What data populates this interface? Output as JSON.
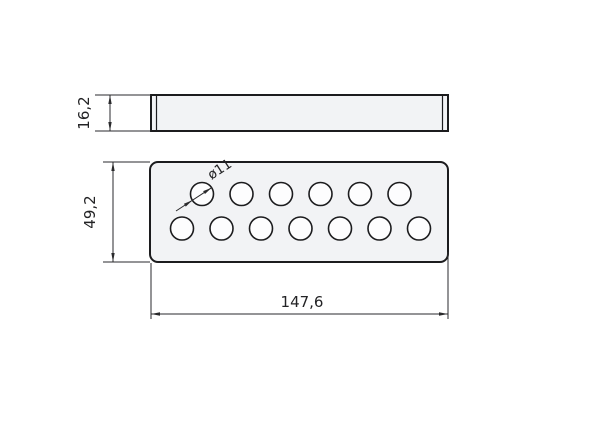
{
  "drawing": {
    "description": "Two-view technical drawing of a perforated rectangular plate",
    "colors": {
      "background": "#ffffff",
      "outline": "#1c1c1e",
      "plate_fill": "#f2f3f5",
      "hole_fill": "#fdfdfe",
      "dim_line": "#2a2a2c",
      "text": "#232325"
    },
    "side_view": {
      "x": 151,
      "y": 95,
      "width": 297,
      "height": 36,
      "inner_edge_offset": 5.5
    },
    "top_view": {
      "x": 150,
      "y": 162,
      "width": 298,
      "height": 100,
      "corner_radius": 8
    },
    "holes": {
      "count": 13,
      "radius": 11.5,
      "rows": [
        {
          "cy": 194,
          "cx": [
            202,
            241.5,
            281,
            320.5,
            360,
            399.5
          ]
        },
        {
          "cy": 228.5,
          "cx": [
            182,
            221.5,
            261,
            300.5,
            340,
            379.5,
            419
          ]
        }
      ]
    },
    "dimensions": {
      "thickness": {
        "label": "16,2",
        "dim_line": {
          "x1": 110,
          "y1": 95,
          "x2": 110,
          "y2": 131
        },
        "arrows": [
          {
            "x": 110,
            "y": 95,
            "angle": -90
          },
          {
            "x": 110,
            "y": 131,
            "angle": 90
          }
        ],
        "ext_lines": [
          [
            95,
            95,
            151,
            95
          ],
          [
            95,
            131,
            151,
            131
          ]
        ],
        "text": {
          "x": 89,
          "y": 113,
          "rotate": -90
        }
      },
      "width": {
        "label": "49,2",
        "dim_line": {
          "x1": 113,
          "y1": 162,
          "x2": 113,
          "y2": 262
        },
        "arrows": [
          {
            "x": 113,
            "y": 162,
            "angle": -90
          },
          {
            "x": 113,
            "y": 262,
            "angle": 90
          }
        ],
        "ext_lines": [
          [
            103,
            162,
            150,
            162
          ],
          [
            103,
            262,
            150,
            262
          ]
        ],
        "text": {
          "x": 95,
          "y": 212,
          "rotate": -90
        }
      },
      "length": {
        "label": "147,6",
        "dim_line": {
          "x1": 151,
          "y1": 314,
          "x2": 448,
          "y2": 314
        },
        "arrows": [
          {
            "x": 151,
            "y": 314,
            "angle": 180
          },
          {
            "x": 448,
            "y": 314,
            "angle": 0
          }
        ],
        "ext_lines": [
          [
            151,
            263,
            151,
            319
          ],
          [
            448,
            252,
            448,
            319
          ]
        ],
        "text": {
          "x": 302,
          "y": 307,
          "rotate": 0
        }
      },
      "hole_diameter": {
        "label": "ø11",
        "dim_line": {
          "x1": 176,
          "y1": 211,
          "x2": 211.6,
          "y2": 187.7
        },
        "arrows": [
          {
            "x": 211.6,
            "y": 187.7,
            "angle": -33
          },
          {
            "x": 192.4,
            "y": 200.3,
            "angle": -33
          }
        ],
        "ext_lines": [],
        "text": {
          "x": 222,
          "y": 173,
          "rotate": -33
        }
      }
    }
  }
}
